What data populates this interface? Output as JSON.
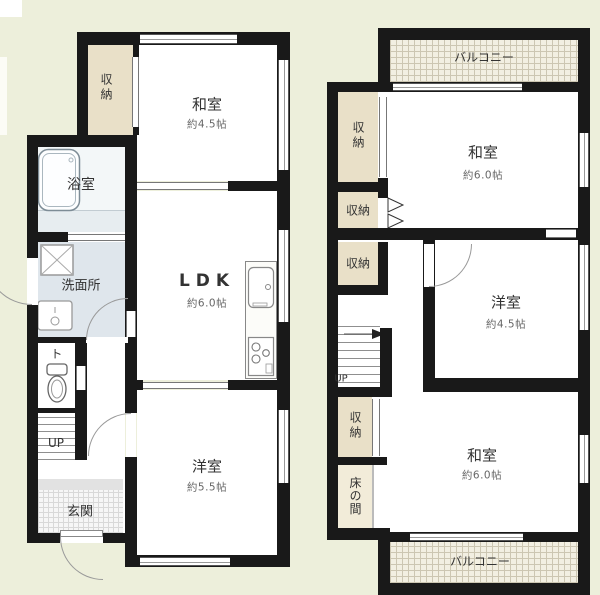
{
  "plan1": {
    "closet_label": "収納",
    "japanese_room": {
      "name": "和室",
      "size": "約4.5帖"
    },
    "bath_label": "浴室",
    "washroom_label": "洗面所",
    "toilet_label": "ト",
    "stairs_label": "UP",
    "entrance_label": "玄関",
    "ldk": {
      "name": "LDK",
      "size": "約6.0帖"
    },
    "western_room": {
      "name": "洋室",
      "size": "約5.5帖"
    }
  },
  "plan2": {
    "balcony_top_label": "バルコニー",
    "closet1_label": "収納",
    "closet2_label": "収納",
    "closet3_label": "収納",
    "closet4_label": "収納",
    "tokonoma_label": "床の間",
    "japanese_room_top": {
      "name": "和室",
      "size": "約6.0帖"
    },
    "western_room": {
      "name": "洋室",
      "size": "約4.5帖"
    },
    "stairs_label": "UP",
    "japanese_room_bottom": {
      "name": "和室",
      "size": "約6.0帖"
    },
    "balcony_bottom_label": "バルコニー"
  },
  "colors": {
    "bg": "#edefdb",
    "wall": "#191919",
    "closet": "#e9e0c8",
    "tokonoma": "#f2ecd9",
    "washroom": "#dfe6ec",
    "bath": "#f3f7f8",
    "bathStrip": "#e7edf0",
    "entranceStep": "#e2e2e2",
    "entranceBg": "#f6f6f6",
    "entranceLine": "#d8d8d8",
    "balconyBg": "#f2efe2",
    "balconyLine": "#ccc6b2",
    "text": "#333333",
    "sizeText": "#666666"
  }
}
